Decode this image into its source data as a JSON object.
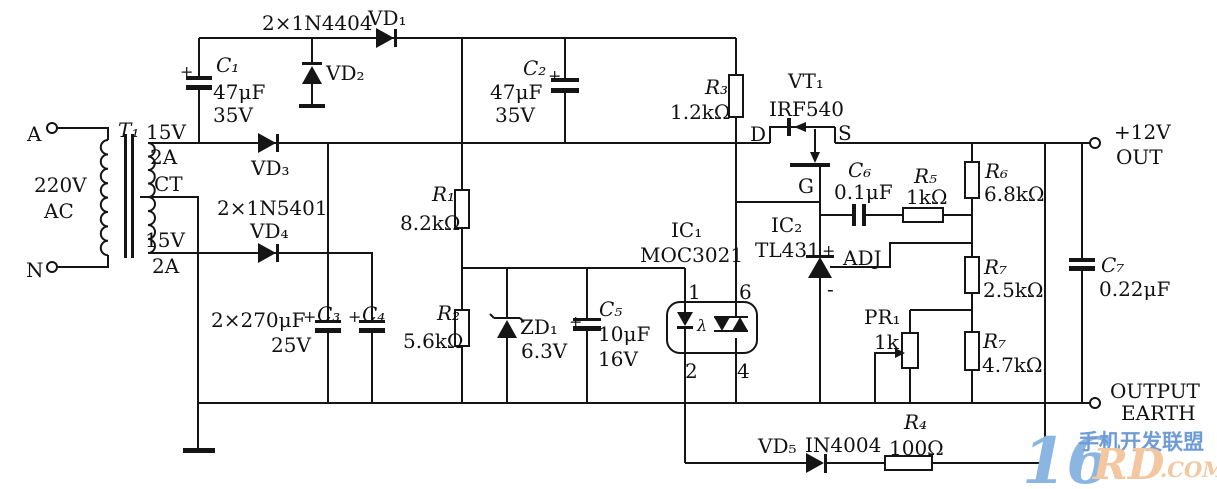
{
  "schematic": {
    "input": {
      "terminal_a": "A",
      "terminal_n": "N",
      "voltage": "220V",
      "current_type": "AC"
    },
    "transformer": {
      "ref": "T₁",
      "sec_top_v": "15V",
      "sec_top_a": "2A",
      "center_tap": "CT",
      "sec_bot_v": "15V",
      "sec_bot_a": "2A"
    },
    "diodes": {
      "vd1_pair": "2×1N4404",
      "vd1": "VD₁",
      "vd2": "VD₂",
      "vd3": "VD₃",
      "vd4_pair": "2×1N5401",
      "vd4": "VD₄",
      "vd5": "VD₅",
      "vd5_part": "IN4004"
    },
    "zener": {
      "ref": "ZD₁",
      "value": "6.3V"
    },
    "capacitors": {
      "c1": {
        "ref": "C₁",
        "value": "47μF",
        "rating": "35V",
        "polarity": "+"
      },
      "c2": {
        "ref": "C₂",
        "value": "47μF",
        "rating": "35V",
        "polarity": "+"
      },
      "c34": {
        "value": "2×270μF",
        "rating": "25V",
        "c3_ref": "C₃",
        "c3_polarity": "+",
        "c4_ref": "C₄",
        "c4_polarity": "+"
      },
      "c5": {
        "ref": "C₅",
        "value": "10μF",
        "rating": "16V",
        "polarity": "+"
      },
      "c6": {
        "ref": "C₆",
        "value": "0.1μF"
      },
      "c7": {
        "ref": "C₇",
        "value": "0.22μF"
      }
    },
    "resistors": {
      "r1": {
        "ref": "R₁",
        "value": "8.2kΩ"
      },
      "r2": {
        "ref": "R₂",
        "value": "5.6kΩ"
      },
      "r3": {
        "ref": "R₃",
        "value": "1.2kΩ"
      },
      "r4": {
        "ref": "R₄",
        "value": "100Ω"
      },
      "r5": {
        "ref": "R₅",
        "value": "1kΩ"
      },
      "r6": {
        "ref": "R₆",
        "value": "6.8kΩ"
      },
      "r7a": {
        "ref": "R₇",
        "value": "2.5kΩ"
      },
      "r7b": {
        "ref": "R₇",
        "value": "4.7kΩ"
      },
      "pr1": {
        "ref": "PR₁",
        "value": "1k"
      }
    },
    "ics": {
      "ic1": {
        "ref": "IC₁",
        "part": "MOC3021",
        "pin1": "1",
        "pin2": "2",
        "pin4": "4",
        "pin6": "6",
        "led_symbol": "λ"
      },
      "ic2": {
        "ref": "IC₂",
        "part": "TL431",
        "plus": "+",
        "minus": "-",
        "adj": "ADJ"
      }
    },
    "mosfet": {
      "ref": "VT₁",
      "part": "IRF540",
      "drain": "D",
      "source": "S",
      "gate": "G"
    },
    "outputs": {
      "pos_line1": "+12V",
      "pos_line2": "OUT",
      "earth_line1": "OUTPUT",
      "earth_line2": "EARTH"
    }
  },
  "watermark": {
    "big": "16",
    "cn": "手机开发联盟",
    "rd": "RD",
    "com": ".COM",
    "blue_light": "#8cb6e2",
    "blue": "#6f9cd6",
    "orange": "#f3c7a0"
  }
}
